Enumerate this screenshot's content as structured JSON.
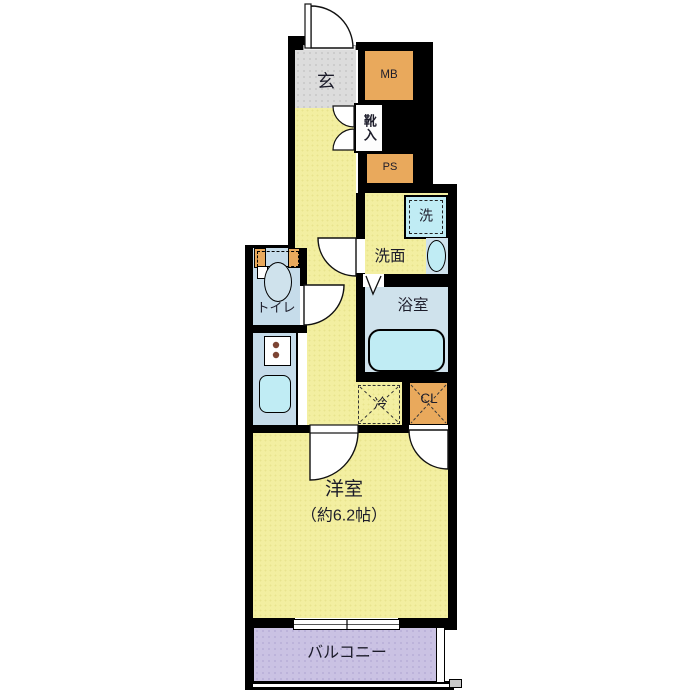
{
  "labels": {
    "entrance": "玄",
    "meter_box": "MB",
    "shoe_cabinet": "靴入",
    "pipe_space": "PS",
    "washer": "洗",
    "washroom": "洗面",
    "bathroom": "浴室",
    "toilet": "トイレ",
    "fridge": "冷",
    "closet": "CL",
    "western_room": "洋室",
    "western_room_size": "（約6.2帖）",
    "balcony": "バルコニー"
  },
  "palette": {
    "wall": "#000000",
    "floor": "#f3efa1",
    "genkan": "#dcdcdc",
    "service": "#e9a95c",
    "wet": "#c6dcea",
    "bath": "#cfe2ec",
    "fixture": "#c0ecf4",
    "balcony": "#cac2e3",
    "ink": "#1c1c2a"
  }
}
